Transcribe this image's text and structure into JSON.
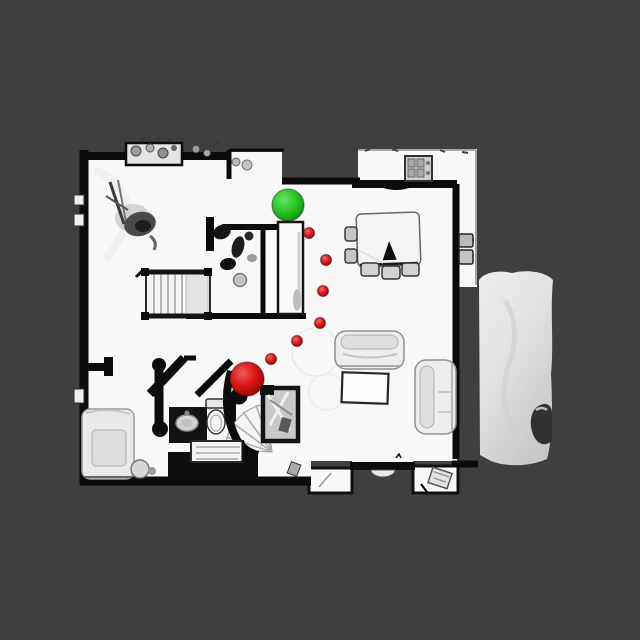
{
  "scene": {
    "description": "Top-down scanned floor plan with navigation markers",
    "background_color": "#3F3F3F",
    "floor_color": "#F8F8F8",
    "wall_color": "#0B0B0B",
    "deck_color_light": "#EBEBEB",
    "deck_color_dark": "#CFCFCF",
    "furniture_color": "#EDEDED"
  },
  "markers": {
    "green": {
      "name": "green-sphere-marker",
      "x": 288,
      "y": 205,
      "radius": 16,
      "color_highlight": "#63E463",
      "color_base": "#25C325",
      "color_edge": "#0F8A0F"
    },
    "red": {
      "name": "red-sphere-marker",
      "x": 247,
      "y": 379,
      "radius": 17,
      "color_highlight": "#F25A5A",
      "color_base": "#D51111",
      "color_edge": "#8E0404"
    },
    "waypoints": {
      "name": "path-waypoint-dot",
      "radius": 5.5,
      "color_highlight": "#F56B6B",
      "color_base": "#DD1414",
      "color_edge": "#9A0707",
      "points": [
        {
          "x": 309,
          "y": 233
        },
        {
          "x": 326,
          "y": 260
        },
        {
          "x": 323,
          "y": 291
        },
        {
          "x": 320,
          "y": 323
        },
        {
          "x": 297,
          "y": 341
        },
        {
          "x": 271,
          "y": 359
        }
      ]
    }
  }
}
